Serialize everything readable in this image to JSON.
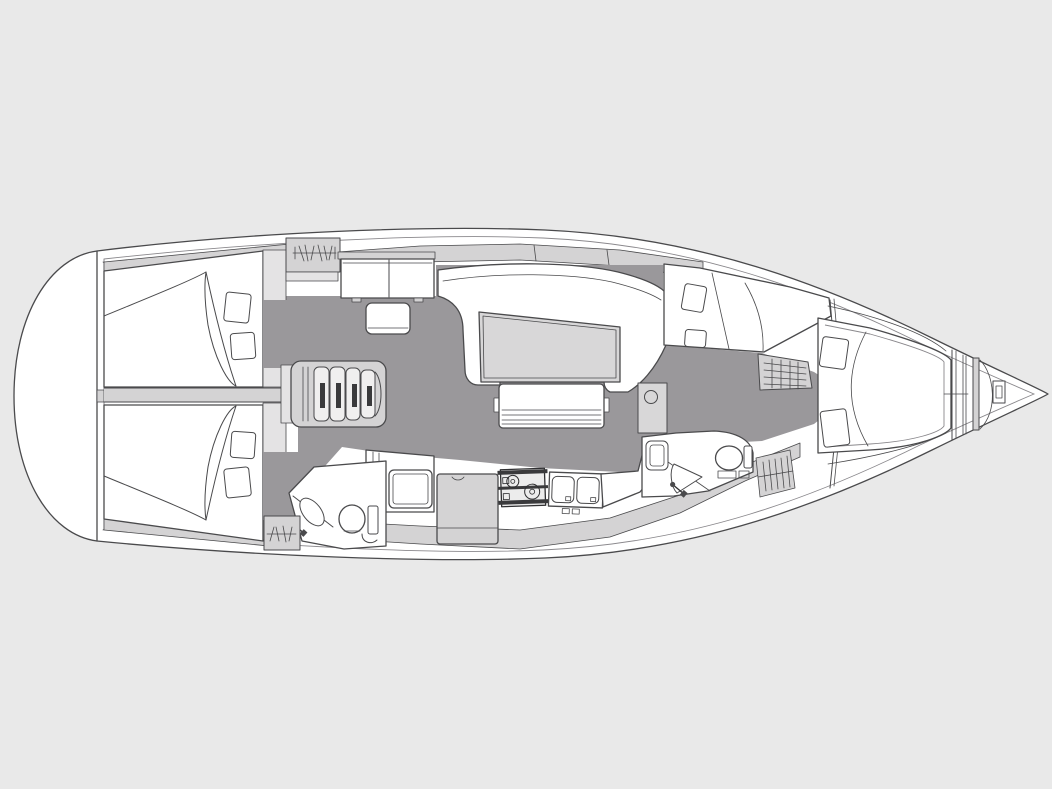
{
  "title": "Sailing yacht interior layout plan — top view, bow to the right",
  "colors": {
    "background": "#e9e9e9",
    "hull": "#ffffff",
    "deck": "#d4d3d4",
    "deck_light": "#e4e3e4",
    "floor": "#9a989b",
    "furniture": "#ffffff",
    "table": "#d8d7d8",
    "tread": "#f0efef",
    "slot_dark": "#3a3a3c"
  },
  "vessel": {
    "type": "monohull sailing yacht floor plan",
    "orientation": "bow right, stern left",
    "areas": [
      {
        "id": "swim-platform",
        "label": "Stern swim platform / transom"
      },
      {
        "id": "aft-cabin-top",
        "label": "Aft double cabin (top) — berth, duvet, two pillows"
      },
      {
        "id": "aft-cabin-bottom",
        "label": "Aft double cabin (bottom) — berth, duvet, two pillows"
      },
      {
        "id": "wardrobe-top",
        "label": "Hanging locker with hanger marks (top)"
      },
      {
        "id": "wardrobe-bottom",
        "label": "Hanging locker with hanger marks (bottom)"
      },
      {
        "id": "companionway-steps",
        "label": "Companionway steps over engine box"
      },
      {
        "id": "nav-station",
        "label": "Chart table with seat"
      },
      {
        "id": "salon",
        "label": "Salon — U-shaped settee, saloon table, movable bench"
      },
      {
        "id": "galley",
        "label": "Galley — refrigerator, counters, two-burner stove, double sink"
      },
      {
        "id": "aft-head",
        "label": "Aft head — basin, shower fitting, toilet"
      },
      {
        "id": "forward-head",
        "label": "Forward head — seat, basin, toilet, hanging locker"
      },
      {
        "id": "port-forward-berth",
        "label": "Forward side berth with two pillows"
      },
      {
        "id": "dressing-seat",
        "label": "Upholstered seat / stowage with comb hatching"
      },
      {
        "id": "owner-cabin",
        "label": "Forward owner cabin — island berth with two pillows"
      },
      {
        "id": "anchor-locker",
        "label": "Bow anchor locker with windlass"
      }
    ]
  }
}
